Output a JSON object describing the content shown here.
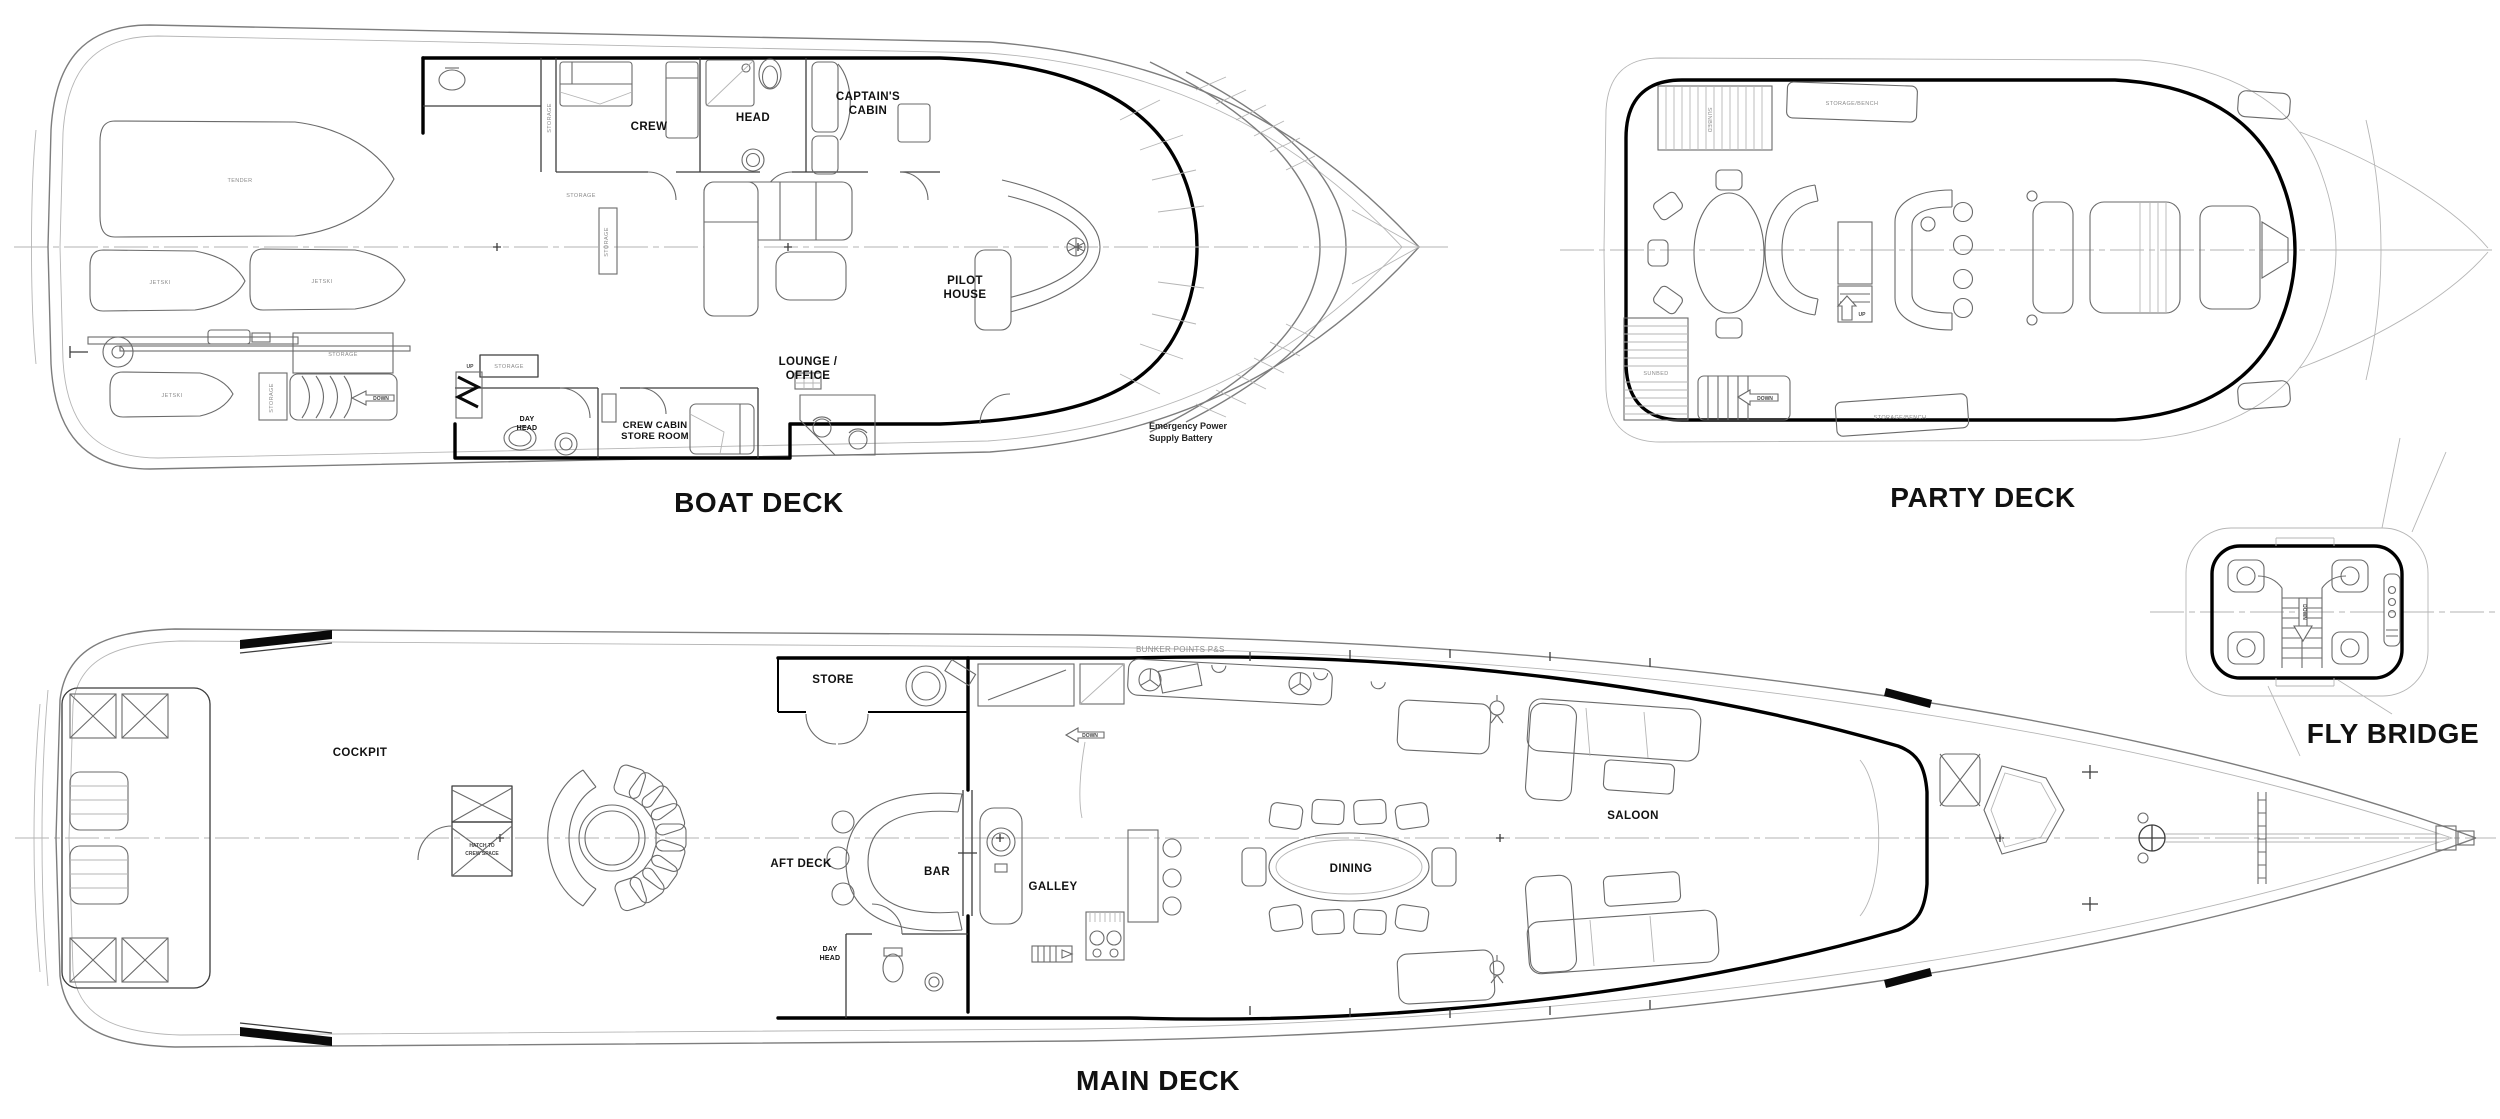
{
  "palette": {
    "background": "#ffffff",
    "wall_line": "#000000",
    "drawing_line": "#6a6a6a",
    "faint_line": "#b5b5b5",
    "label_color": "#111111",
    "annotation_color": "#8a8a8a"
  },
  "decks": {
    "boat": {
      "title": "BOAT DECK",
      "labels": {
        "crew": "CREW",
        "head": "HEAD",
        "captains_cabin": [
          "CAPTAIN'S",
          "CABIN"
        ],
        "pilot_house": [
          "PILOT",
          "HOUSE"
        ],
        "lounge_office": [
          "LOUNGE /",
          "OFFICE"
        ],
        "day_head": [
          "DAY",
          "HEAD"
        ],
        "crew_cabin_store_room": [
          "CREW CABIN",
          "STORE ROOM"
        ],
        "emergency_power": [
          "Emergency Power",
          "Supply Battery"
        ],
        "tender": "TENDER",
        "jetski": "JETSKI",
        "storage": "STORAGE",
        "down": "DOWN",
        "up": "UP"
      }
    },
    "party": {
      "title": "PARTY DECK",
      "labels": {
        "sunbed": "SUNBED",
        "storage_bench": "STORAGE/BENCH",
        "down": "DOWN",
        "up": "UP"
      }
    },
    "fly": {
      "title": "FLY BRIDGE",
      "labels": {
        "down": "DOWN"
      }
    },
    "main": {
      "title": "MAIN DECK",
      "labels": {
        "cockpit": "COCKPIT",
        "aft_deck": "AFT DECK",
        "bar": "BAR",
        "store": "STORE",
        "galley": "GALLEY",
        "day_head": [
          "DAY",
          "HEAD"
        ],
        "dining": "DINING",
        "saloon": "SALOON",
        "hatch_to_crew_space": [
          "HATCH TO",
          "CREW SPACE"
        ],
        "bunker_points": "BUNKER POINTS P&S",
        "down": "DOWN"
      }
    }
  }
}
